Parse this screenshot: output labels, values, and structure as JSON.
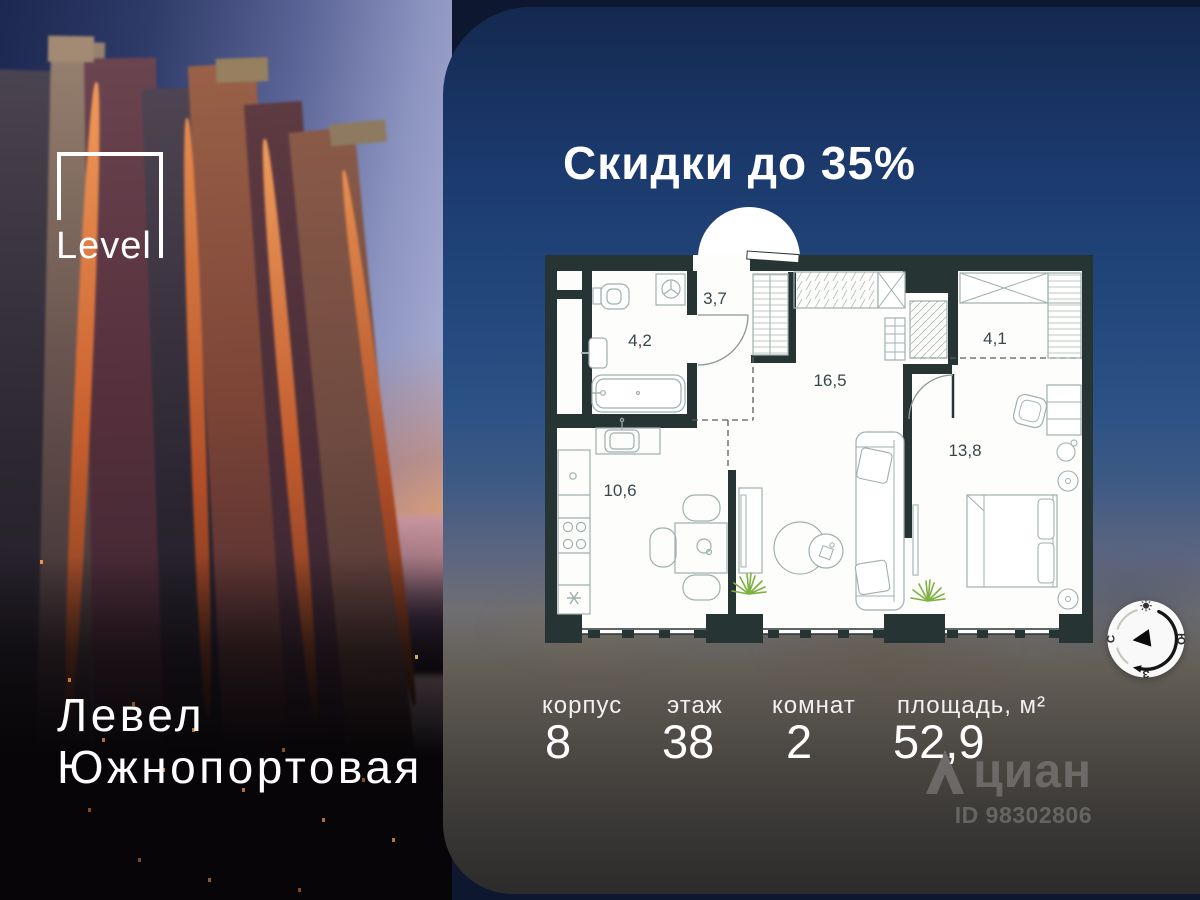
{
  "branding": {
    "logo_text": "Level",
    "project_line1": "Левел",
    "project_line2": "Южнопортовая"
  },
  "promo": {
    "title": "Скидки до 35%"
  },
  "floor_plan": {
    "rooms": [
      {
        "area": "3,7"
      },
      {
        "area": "4,2"
      },
      {
        "area": "16,5"
      },
      {
        "area": "4,1"
      },
      {
        "area": "13,8"
      },
      {
        "area": "10,6"
      }
    ]
  },
  "details": {
    "columns": [
      {
        "label": "корпус",
        "value": "8"
      },
      {
        "label": "этаж",
        "value": "38"
      },
      {
        "label": "комнат",
        "value": "2"
      },
      {
        "label": "площадь, м²",
        "value": "52,9"
      }
    ]
  },
  "watermark": {
    "brand": "циан",
    "id_label": "ID 98302806"
  },
  "compass": {
    "left_letter": "С",
    "right_letter": "Ю",
    "bottom_letter": "З"
  },
  "colors": {
    "wall": "#273434",
    "panel_top": "#14294f",
    "accent_orange": "#c96a3c",
    "plant_green": "#7fb043"
  }
}
